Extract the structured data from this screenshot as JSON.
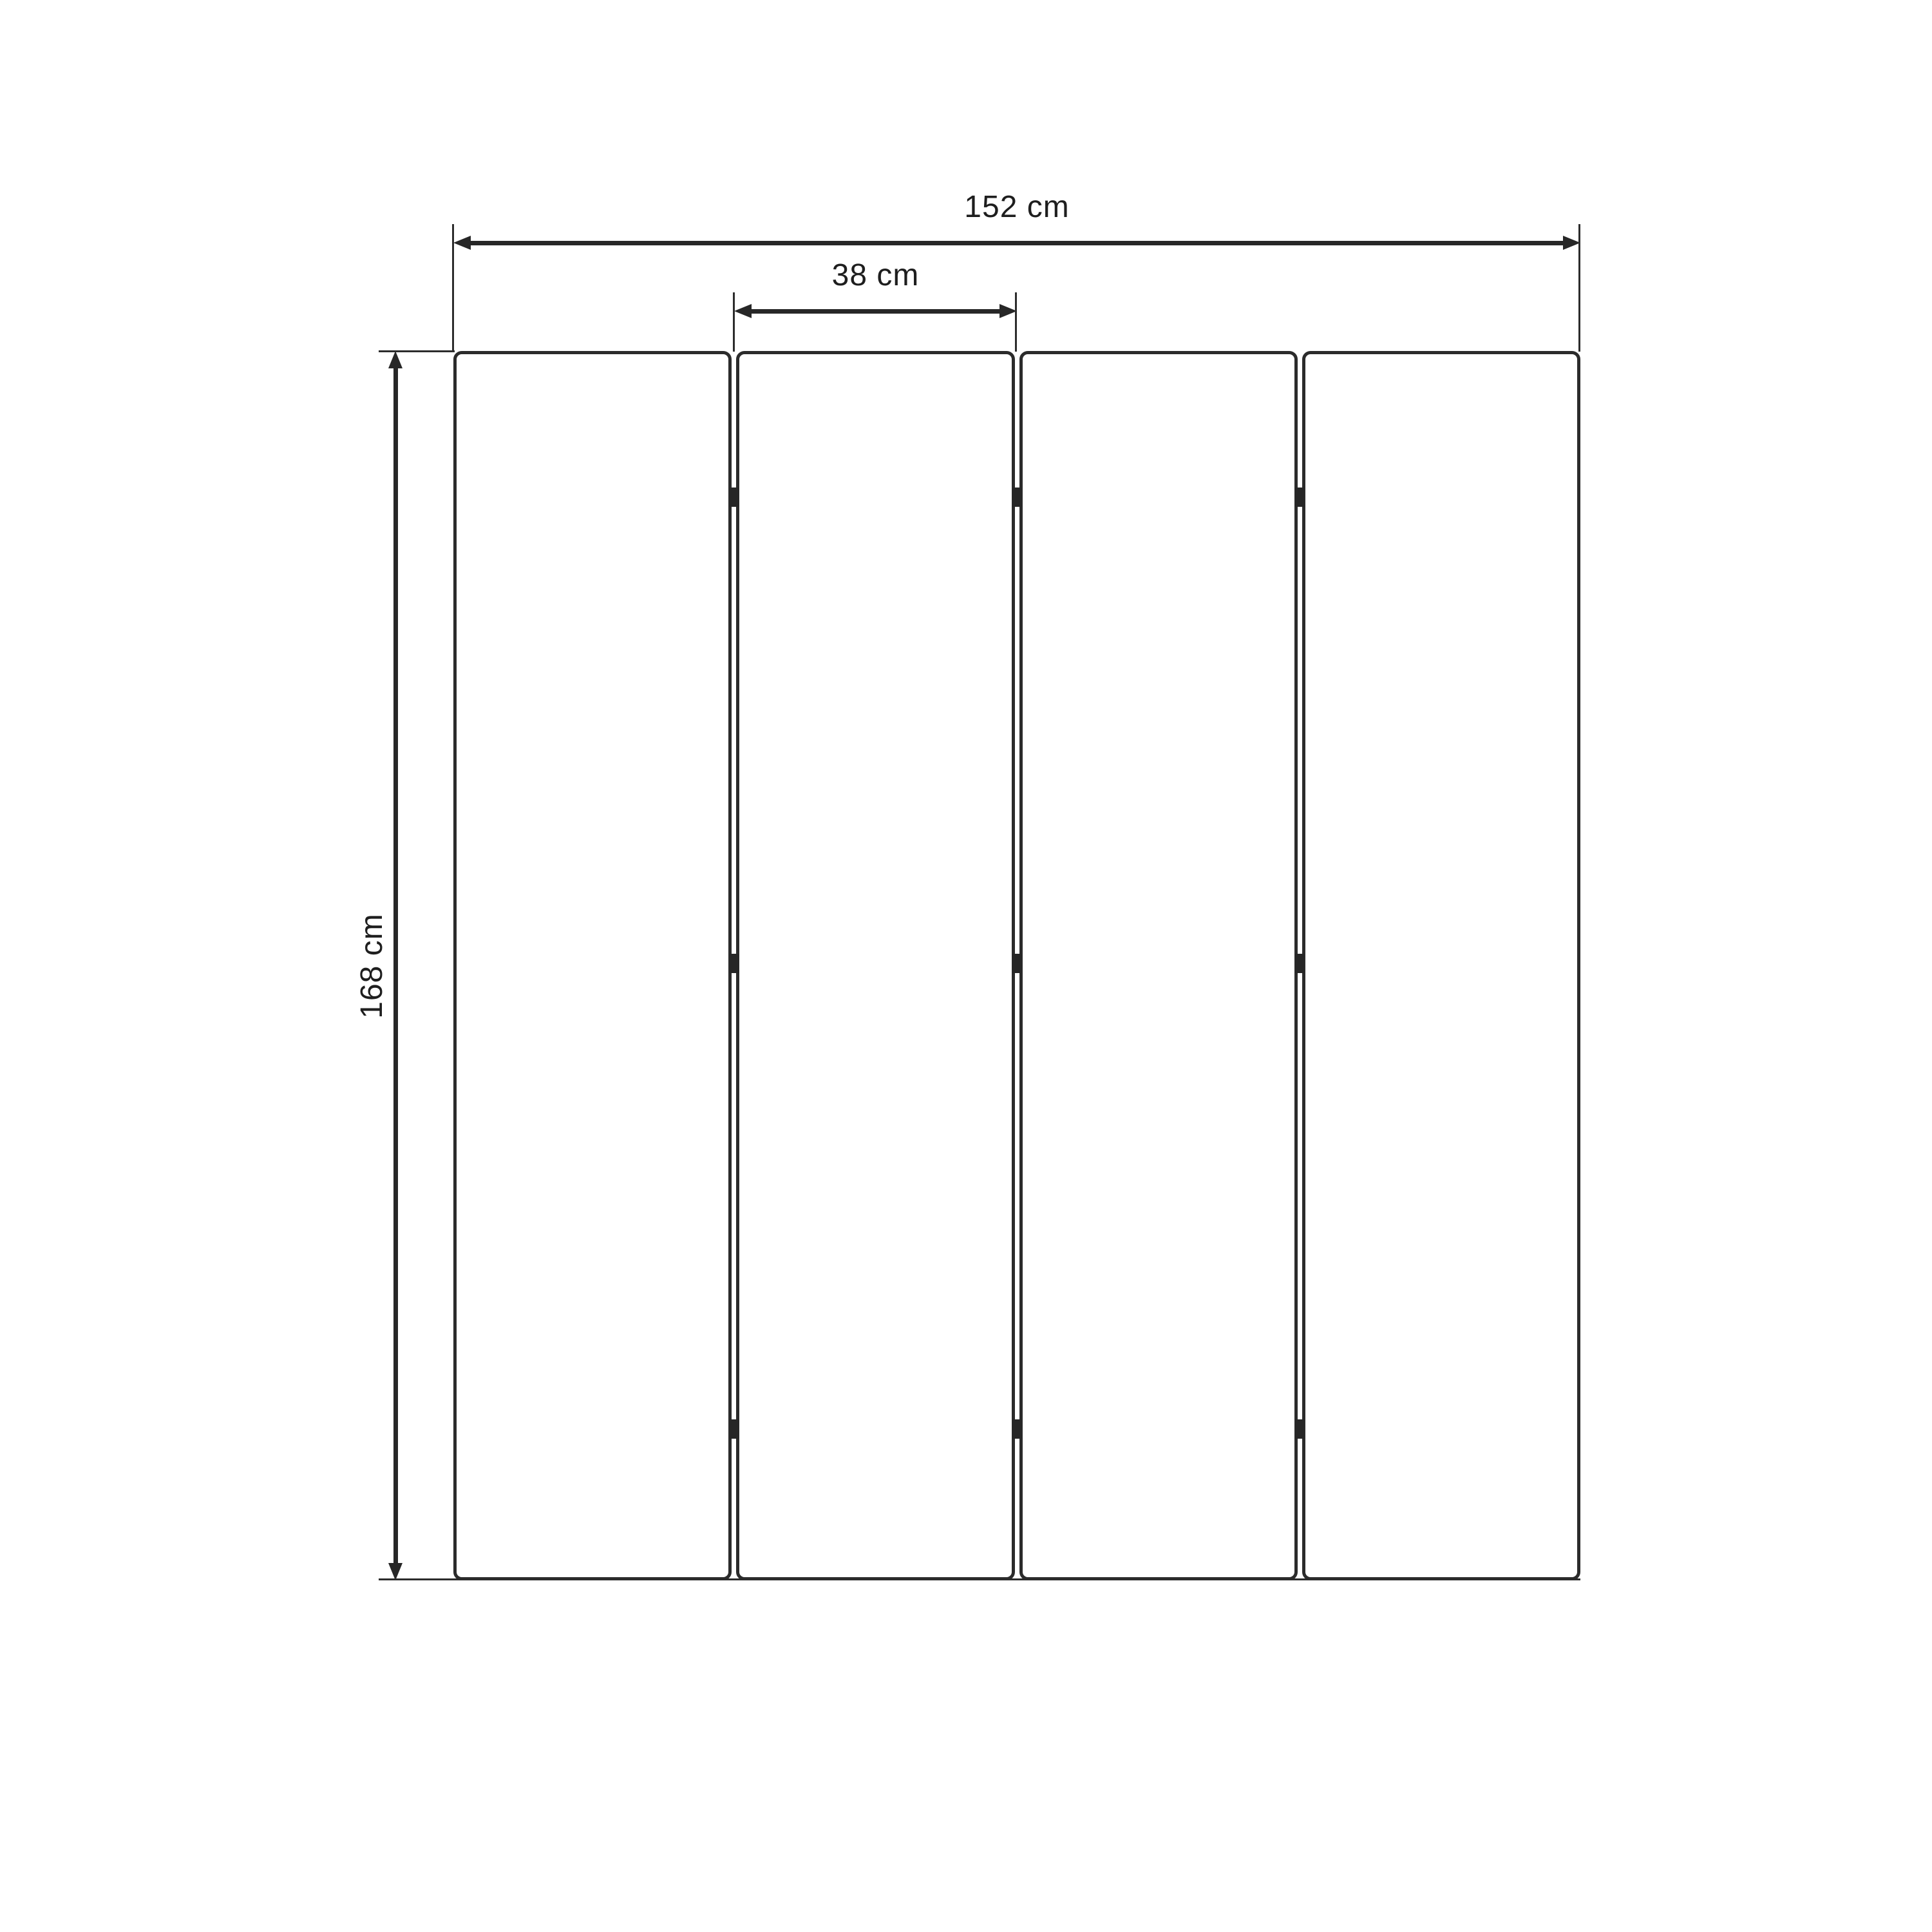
{
  "title": "Folding screen technical dimension drawing",
  "dimensions": {
    "total_width": {
      "label": "152 cm",
      "orientation": "horizontal"
    },
    "panel_width": {
      "label": "38 cm",
      "orientation": "horizontal"
    },
    "height": {
      "label": "168 cm",
      "orientation": "vertical"
    }
  },
  "panels": {
    "count": 4,
    "hinge_positions": [
      0.119,
      0.498,
      0.877
    ],
    "hinges_per_gap": 3
  },
  "colors": {
    "line": "#272727",
    "text": "#1e1e1e",
    "background": "#ffffff"
  }
}
